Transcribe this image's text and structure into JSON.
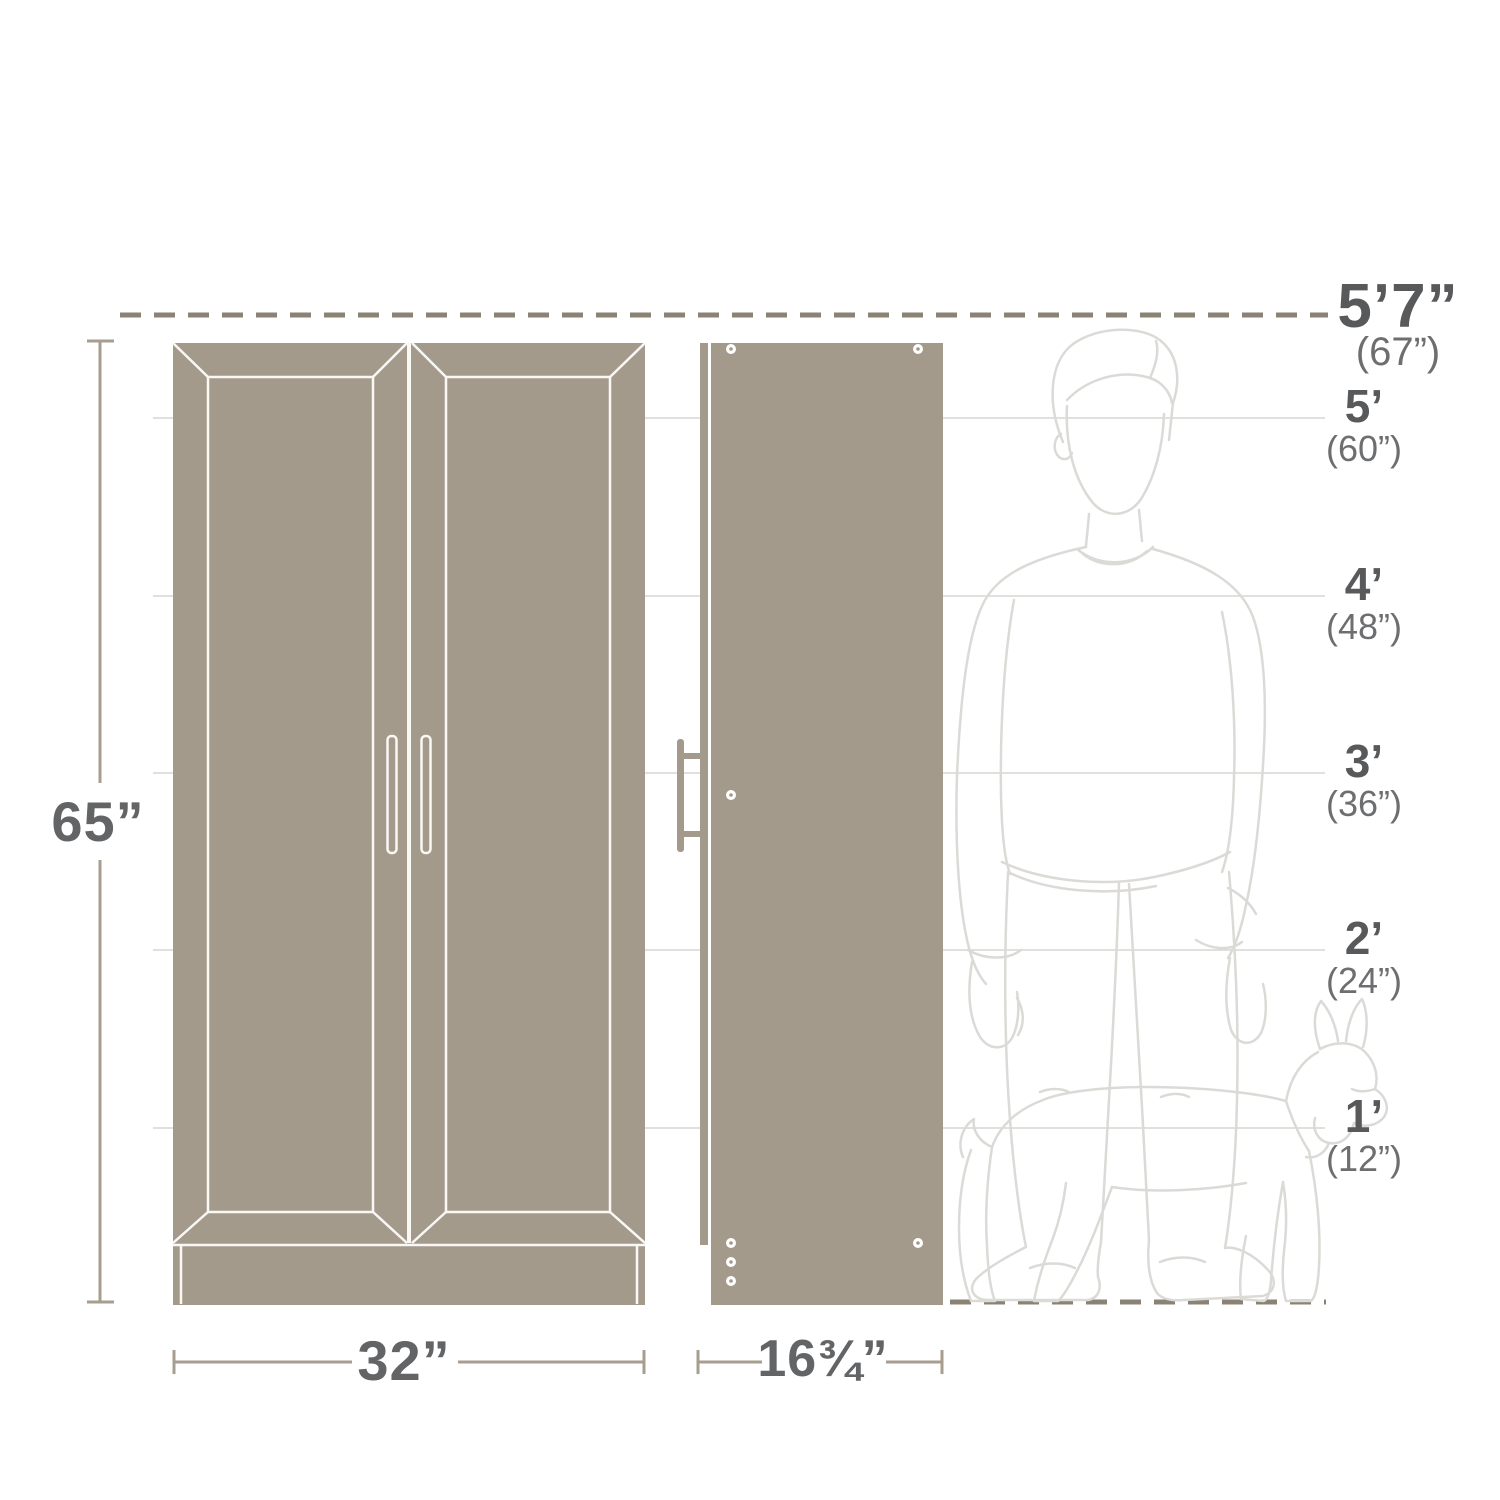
{
  "diagram": {
    "name": "Storage cabinet dimensions diagram"
  },
  "dimensions": {
    "height": "65”",
    "width": "32”",
    "depth": "16¾”"
  },
  "scale": {
    "top_feet": "5’7”",
    "top_inches": "(67”)",
    "marks": [
      {
        "feet": "5’",
        "inches": "(60”)"
      },
      {
        "feet": "4’",
        "inches": "(48”)"
      },
      {
        "feet": "3’",
        "inches": "(36”)"
      },
      {
        "feet": "2’",
        "inches": "(24”)"
      },
      {
        "feet": "1’",
        "inches": "(12”)"
      }
    ]
  },
  "figures": {
    "person": "adult-person-outline",
    "dog": "dog-outline"
  },
  "colors": {
    "cabinet": "#a49a8c",
    "cabinet_line": "#faf8f5",
    "dimension_line": "#a79e90",
    "dashed_line": "#8b8276",
    "grid_line": "#d6d5d2",
    "figure_line": "#dbdad6",
    "text_primary": "#58595b",
    "text_secondary": "#6d6e70"
  }
}
